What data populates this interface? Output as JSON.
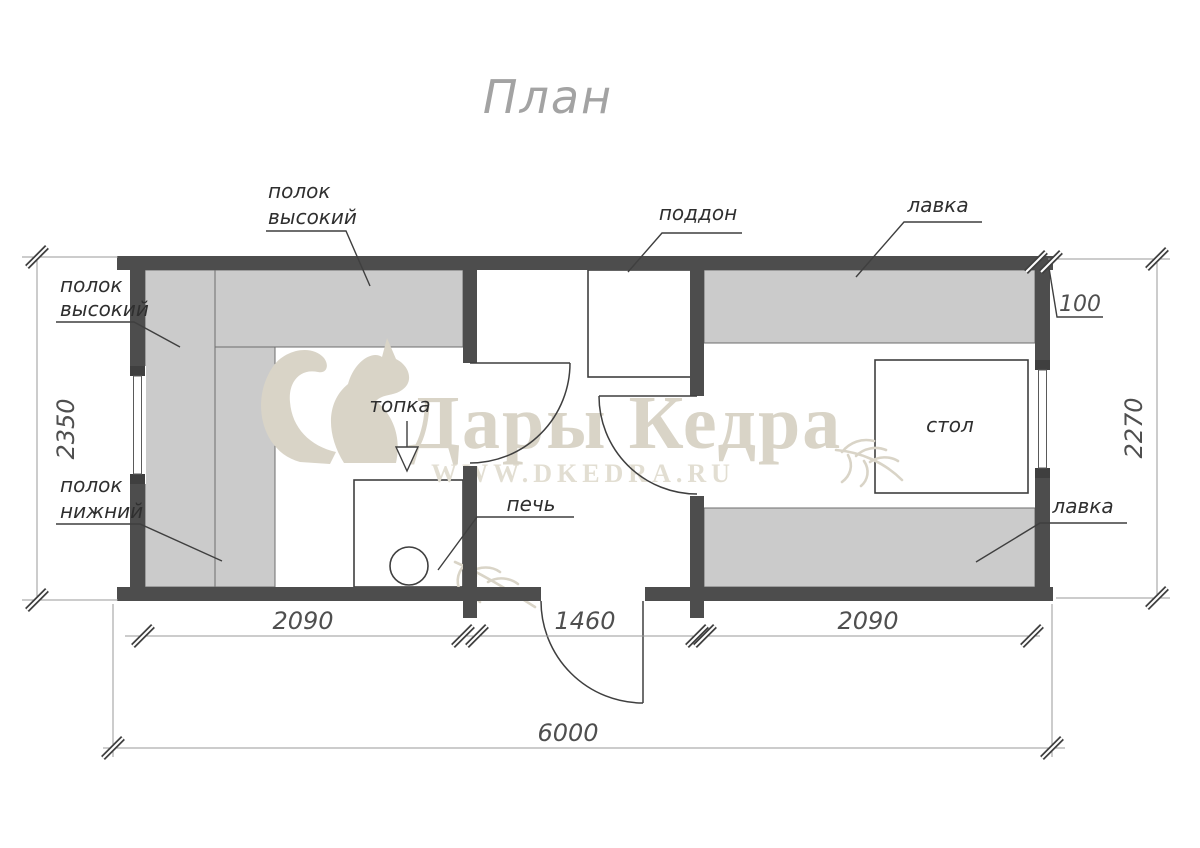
{
  "title": "План",
  "watermark": {
    "brand": "Дары Кедра",
    "url": "WWW.DKEDRA.RU",
    "color": "#d9d4c7",
    "url_color": "#e2ded2"
  },
  "colors": {
    "wall": "#4d4d4d",
    "bench_fill": "#cbcbcb",
    "line": "#3f3f3f",
    "dim_line": "#9a9a9a",
    "label_text": "#2f2f2f",
    "dim_text": "#4f4f4f",
    "title_text": "#a3a3a3"
  },
  "labels": {
    "shelf_high": {
      "line1": "полок",
      "line2": "высокий"
    },
    "shelf_low": {
      "line1": "полок",
      "line2": "нижний"
    },
    "firebox": "топка",
    "stove": "печь",
    "tray": "поддон",
    "bench": "лавка",
    "table": "стол"
  },
  "dimensions": {
    "steam_room_width": "2090",
    "washing_room_width": "1460",
    "rest_room_width": "2090",
    "total_width": "6000",
    "depth_outer": "2350",
    "depth_inner": "2270",
    "wall_thickness": "100"
  }
}
